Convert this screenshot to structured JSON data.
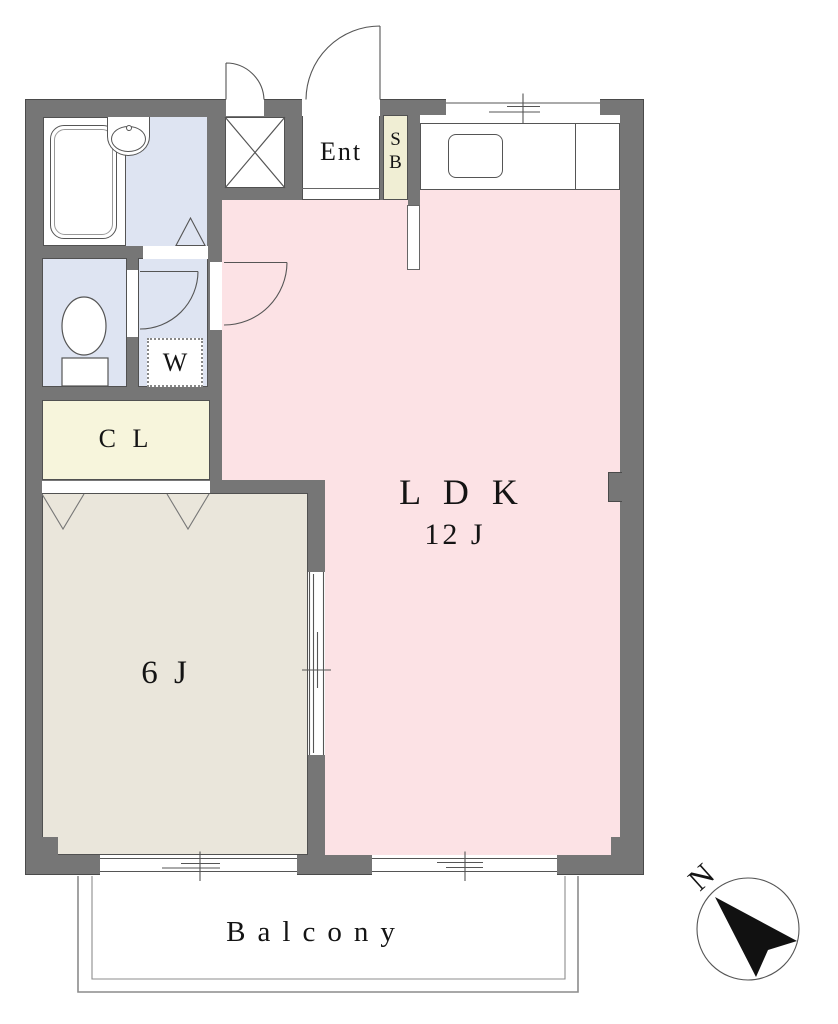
{
  "title": "1LDK apartment floor plan",
  "rooms": {
    "entrance": {
      "label": "Ent"
    },
    "shoe_box": {
      "letters": [
        "S",
        "B"
      ]
    },
    "washer_space": {
      "label": "W"
    },
    "closet": {
      "label": "C L"
    },
    "living_dining_kitchen": {
      "label": "L D K",
      "size": "12 J"
    },
    "bedroom": {
      "label": "6 J"
    },
    "balcony": {
      "label": "Balcony"
    }
  },
  "compass": {
    "north_label": "N"
  },
  "fixtures": [
    "bathtub",
    "washbasin",
    "toilet",
    "kitchen-sink",
    "washing-machine-space",
    "shoe-box",
    "storage-shaft",
    "balcony"
  ],
  "colors": {
    "wall": "#767676",
    "ldk_floor": "#fce2e5",
    "wet_area_floor": "#dee4f2",
    "closet_floor": "#f7f5dc",
    "shoe_box": "#f0eed4",
    "bedroom_floor": "#eae6db",
    "outline": "#555555"
  }
}
